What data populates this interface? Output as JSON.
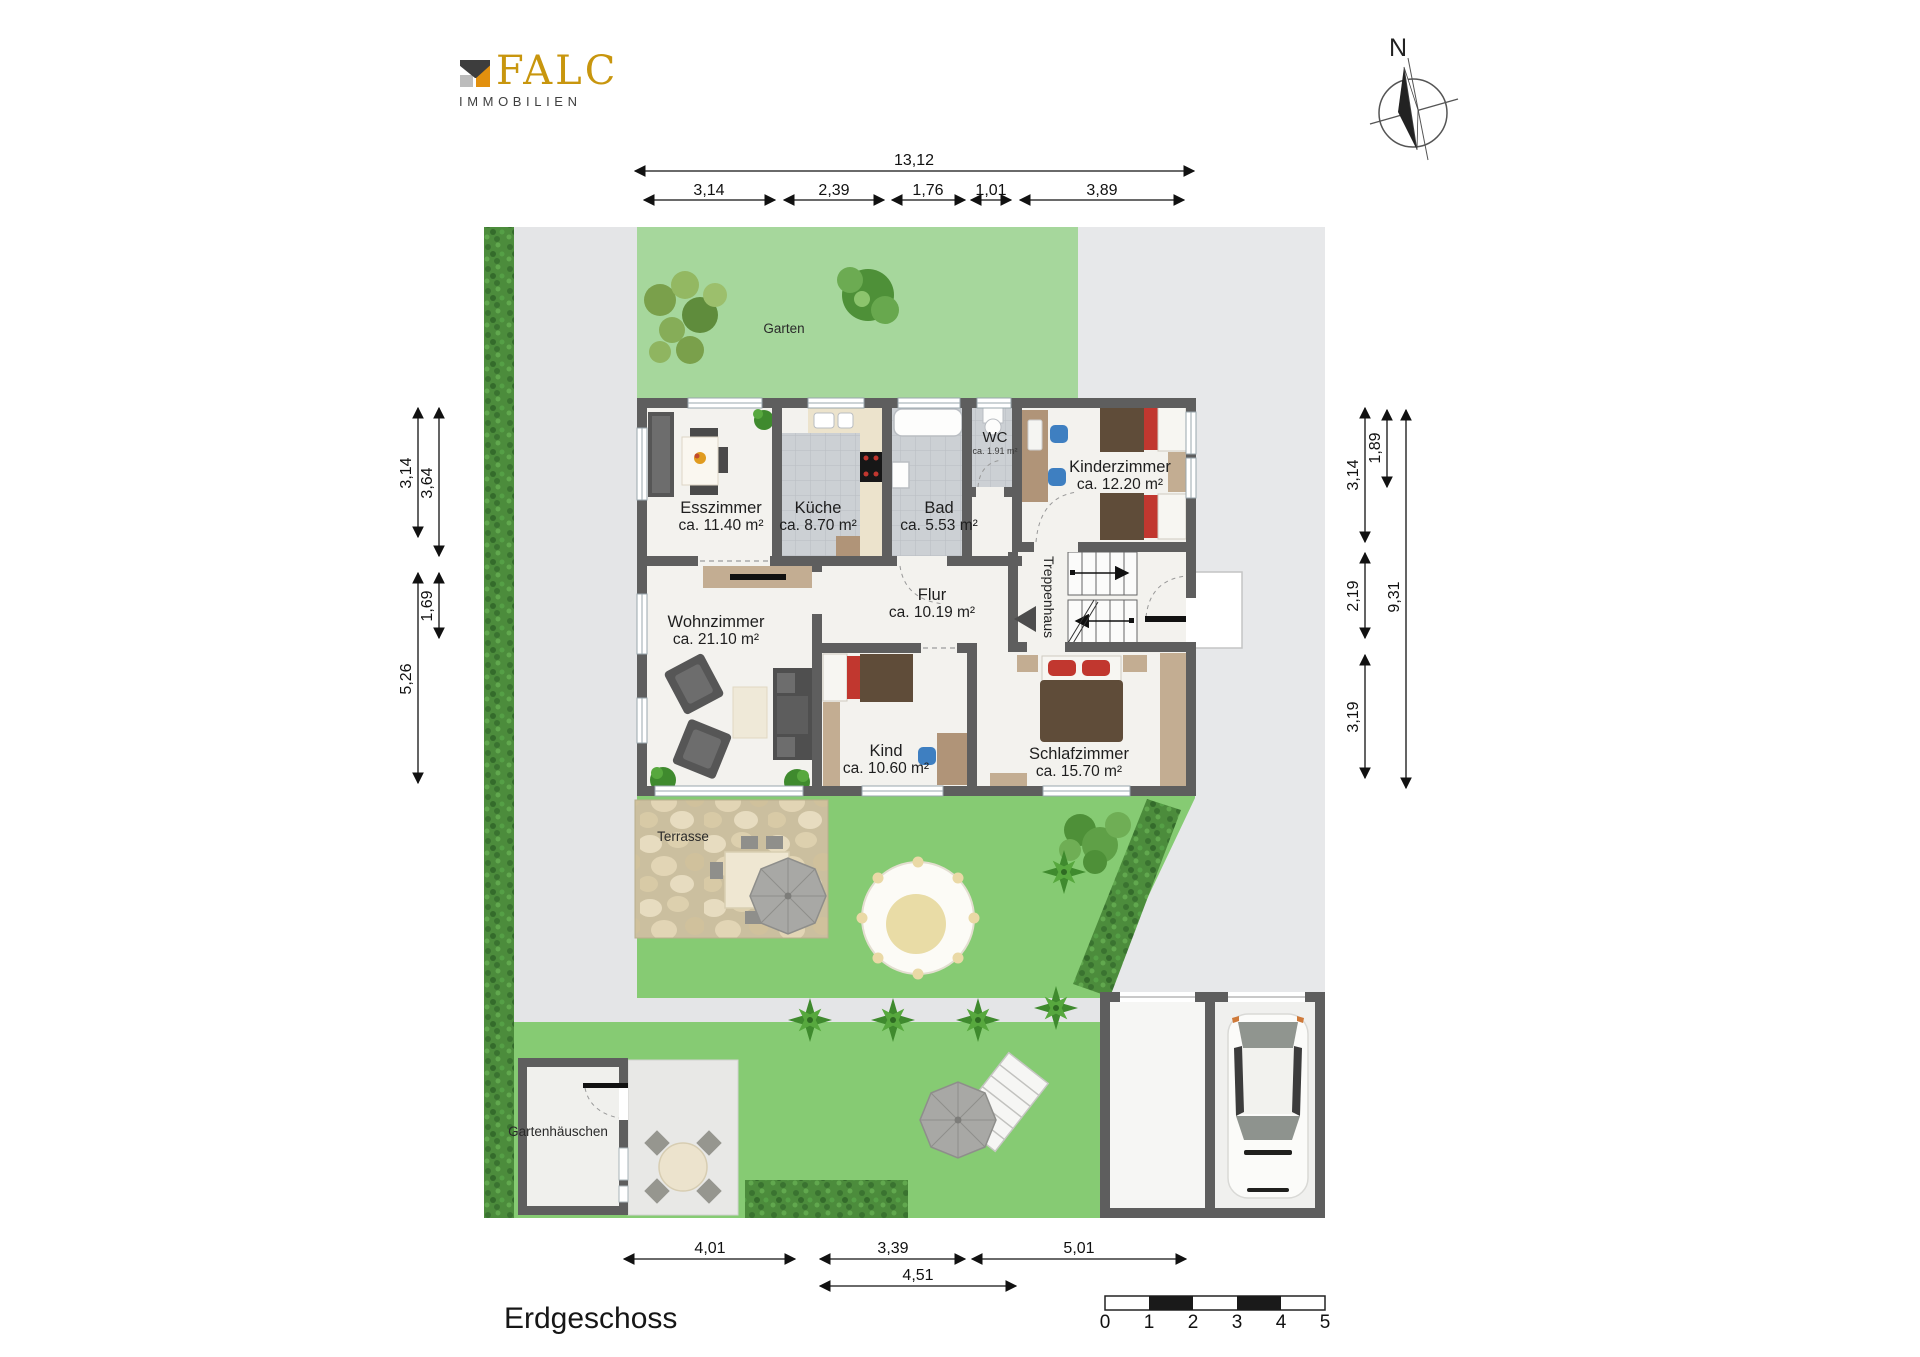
{
  "branding": {
    "logo_text": "FALC",
    "logo_subtext": "IMMOBILIEN"
  },
  "compass": {
    "north_label": "N"
  },
  "title": {
    "floor_label": "Erdgeschoss"
  },
  "dimensions": {
    "top": {
      "total": "13,12",
      "segments": [
        "3,14",
        "2,39",
        "1,76",
        "1,01",
        "3,89"
      ]
    },
    "left": {
      "outer_top": "3,14",
      "outer_bottom": "5,26",
      "inner_top": "3,64",
      "inner_middle": "1,69"
    },
    "right": {
      "inner_top": "3,14",
      "inner_middle": "2,19",
      "inner_bottom": "3,19",
      "mid": "1,89",
      "outer": "9,31"
    },
    "bottom": {
      "row1": [
        "4,01",
        "3,39",
        "5,01"
      ],
      "row2": "4,51"
    }
  },
  "rooms": {
    "esszimmer": {
      "name": "Esszimmer",
      "area": "ca. 11.40 m²"
    },
    "kueche": {
      "name": "Küche",
      "area": "ca. 8.70 m²"
    },
    "bad": {
      "name": "Bad",
      "area": "ca. 5.53 m²"
    },
    "wc": {
      "name": "WC",
      "area": "ca. 1.91 m²"
    },
    "kinderzimmer": {
      "name": "Kinderzimmer",
      "area": "ca. 12.20 m²"
    },
    "flur": {
      "name": "Flur",
      "area": "ca. 10.19 m²"
    },
    "treppenhaus": {
      "name": "Treppenhaus"
    },
    "wohnzimmer": {
      "name": "Wohnzimmer",
      "area": "ca. 21.10 m²"
    },
    "kind": {
      "name": "Kind",
      "area": "ca. 10.60 m²"
    },
    "schlafzimmer": {
      "name": "Schlafzimmer",
      "area": "ca. 15.70 m²"
    }
  },
  "outdoor": {
    "garten": "Garten",
    "terrasse": "Terrasse",
    "gartenhaeuschen": "Gartenhäuschen"
  },
  "scale_bar": {
    "labels": [
      "0",
      "1",
      "2",
      "3",
      "4",
      "5"
    ]
  },
  "colors": {
    "lawn": "#86cb73",
    "lawn_light": "#a6d79c",
    "hedge": "#4c8c3c",
    "path_gray": "#e4e5e7",
    "wall": "#5e5e5e",
    "accent_gold": "#c8960e"
  }
}
